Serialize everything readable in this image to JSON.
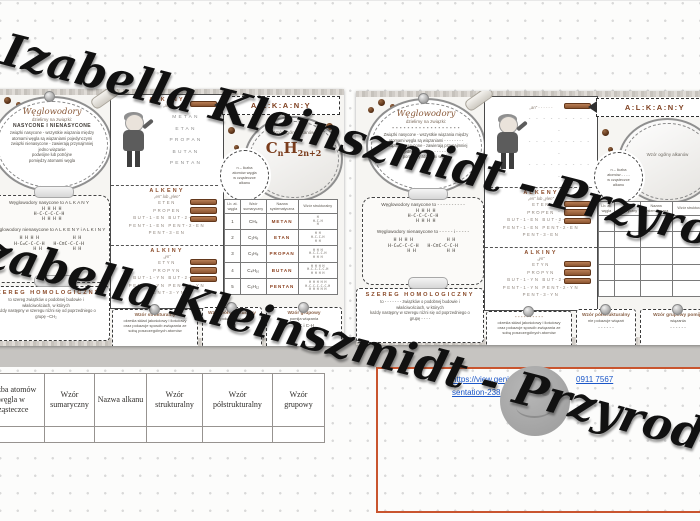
{
  "colors": {
    "accent_brown": "#8a4a28",
    "formula_brown": "#7a3c1c",
    "link_blue": "#1a56c8",
    "box_orange": "#c9552f",
    "band_gray": "#c6c4c1"
  },
  "watermark": {
    "line": "Izabella Kleinszmidt - PrzyrodniczeEcho"
  },
  "page1": {
    "oval": {
      "title": "Węglowodory",
      "subtitle": "dzielimy na związki:",
      "emphasis": "NASYCONE I NIENASYCONE",
      "lines": "związki nasycone - wszystkie wiązania między\natomami węgla są wiązaniami pojedynczymi\nzwiązki nienasycone - zawierają przynajmniej\njedno wiązanie\npodwójne lub potrójne\npomiędzy atomami węgla"
    },
    "sat": {
      "line1": "Węglowodory nasycone to  A L K A N Y",
      "formula1": "  H H H H\nH-C-C-C-C-H\n  H H H H",
      "line2": "Węglowodory nienasycone to  A L K E N Y  i  A L K I N Y",
      "formula2a": "H H H H\nH-C=C-C-C-H\n      H H",
      "formula2b": "      H H\nH-C≡C-C-C-H\n      H H"
    },
    "szereg": {
      "title": "SZEREG HOMOLOGICZNY",
      "text": "to szereg związków o podobnej budowie i\nwłaściwościach, w których\nkażdy następny w szeregu różni się od poprzedniego o\ngrupę –CH₂"
    },
    "alkany": {
      "title": "ALKANY",
      "suffix": "„an”",
      "names": [
        "METAN",
        "ETAN",
        "PROPAN",
        "BUTAN",
        "PENTAN"
      ]
    },
    "alkeny": {
      "title": "ALKENY",
      "suffix": "„en” lub „ylen”",
      "names": [
        "ETEN",
        "PROPEN",
        "BUT-1-EN  BUT-2-EN",
        "PENT-1-EN  PENT-2-EN",
        "PENT-3-EN"
      ]
    },
    "alkiny": {
      "title": "ALKINY",
      "suffix": "„yn”",
      "names": [
        "ETYN",
        "PROPYN",
        "BUT-1-YN  BUT-2-YN",
        "PENT-1-YN  PENT-2-YN",
        "PENT-3-YN"
      ]
    },
    "ribbon": "A:L:K:A:N:Y",
    "general": {
      "label": "Wzór ogólny alkanów",
      "c": "C",
      "n": "n",
      "h": "H",
      "sub": "2n+2"
    },
    "circle_note": "n – liczba\natomów węgla\nw cząsteczce\nalkanu",
    "table": {
      "headers": [
        "Lb. at.\nwęgla",
        "Wzór\nsumaryczny",
        "Nazwa\nsystematyczna",
        "Wzór strukturalny"
      ],
      "rows": [
        {
          "n": "1",
          "sum": "CH₄",
          "name": "METAN",
          "struct": "H\nH-C-H\nH"
        },
        {
          "n": "2",
          "sum": "C₂H₆",
          "name": "ETAN",
          "struct": "H H\nH-C-C-H\nH H"
        },
        {
          "n": "3",
          "sum": "C₃H₈",
          "name": "PROPAN",
          "struct": "H H H\nH-C-C-C-H\nH H H"
        },
        {
          "n": "4",
          "sum": "C₄H₁₀",
          "name": "BUTAN",
          "struct": "H H H H\nH-C-C-C-C-H\nH H H H"
        },
        {
          "n": "5",
          "sum": "C₅H₁₂",
          "name": "PENTAN",
          "struct": "H H H H H\nH-C-C-C-C-C-H\nH H H H H"
        }
      ]
    },
    "banner_struct": {
      "title": "Wzór strukturalny",
      "text": "określa skład jakościowy i ilościowy\noraz pokazuje sposób związania ze\nsobą poszczególnych atomów"
    },
    "banner_semi": {
      "title": "Wzór półstrukturalny",
      "text": "nie pokazuje wiązań",
      "value": "C-H"
    },
    "banner_group": {
      "title": "Wzór grupowy",
      "text": "pomija wiązania",
      "value": "C-C i C-H"
    }
  },
  "page2": {
    "oval": {
      "title": "Węglowodory",
      "subtitle": "dzielimy na związki:",
      "emphasis": "- - - - - - - - - - - - - - - - - -",
      "lines": "Związki nasycone - wszystkie wiązania między\natomami węgla są wiązaniami - - - - - - - -\nZwiązki nienasycone - zawierają przynajmniej\njedno wiązanie - - - - - - -\npomiędzy atomami węgla"
    },
    "sat": {
      "line1": "Węglowodory nasycone to  - - - - - - - - - -",
      "formula1": "  H H H H\nH-C-C-C-C-H\n  H H H H",
      "line2": "Węglowodory nienasycone to  - - - - -  i  - - - - -",
      "formula2a": "H H H H\nH-C=C-C-C-H\n      H H",
      "formula2b": "      H H\nH-C≡C-C-C-H\n      H H"
    },
    "szereg": {
      "title": "SZEREG HOMOLOGICZNY",
      "text": "to - - - - - - - związków o podobnej budowie i\nwłaściwościach, w których\nkażdy następny w szeregu różni się od poprzedniego o\ngrupę - - - -"
    },
    "alkany": {
      "title": "",
      "suffix": "„an”  - - - - - -",
      "names": [
        "- - - - - - - - - -",
        "- - - - - - - - - -",
        "- - - - - - - - - -",
        "- - - - - - - - - -",
        "- - - - - - - - - -"
      ]
    },
    "alkeny": {
      "title": "ALKENY",
      "suffix": "„en” lub „ylen”",
      "names": [
        "ETEN",
        "PROPEN",
        "BUT-1-EN  BUT-2-EN",
        "PENT-1-EN  PENT-2-EN",
        "PENT-3-EN"
      ]
    },
    "alkiny": {
      "title": "ALKINY",
      "suffix": "„yn”",
      "names": [
        "ETYN",
        "PROPYN",
        "BUT-1-YN  BUT-2-YN",
        "PENT-1-YN  PENT-2-YN",
        "PENT-3-YN"
      ]
    },
    "ribbon": "A:L:K:A:N:Y",
    "general": {
      "label": "Wzór ogólny alkanów",
      "c": "",
      "n": "",
      "h": "",
      "sub": ""
    },
    "circle_note": "n – liczba\natomów - - - -\nw cząsteczce\nalkanu",
    "table": {
      "headers": [
        "Lb. at.\nwęgla",
        "Wzór\nsumaryczny",
        "Nazwa\nsystematyczna",
        "Wzór strukturalny"
      ],
      "rows": [
        {
          "n": "",
          "sum": "",
          "name": "",
          "struct": ""
        },
        {
          "n": "",
          "sum": "",
          "name": "",
          "struct": ""
        },
        {
          "n": "",
          "sum": "",
          "name": "",
          "struct": ""
        },
        {
          "n": "",
          "sum": "",
          "name": "",
          "struct": ""
        },
        {
          "n": "",
          "sum": "",
          "name": "",
          "struct": ""
        }
      ]
    },
    "banner_struct": {
      "title": "- - - - - - - - - -",
      "text": "określa skład jakościowy i ilościowy\noraz pokazuje sposób związania ze\nsobą poszczególnych atomów"
    },
    "banner_semi": {
      "title": "Wzór półstrukturalny",
      "text": "nie pokazuje wiązań",
      "value": "- - - - - -"
    },
    "banner_group": {
      "title": "Wzór grupowy pomija",
      "text": "wiązania",
      "value": "- - - - - -"
    }
  },
  "footer": {
    "page_number": "2"
  },
  "doc_table": {
    "headers": [
      "Liczba atomów\nwęgla w\ncząsteczce",
      "Wzór\nsumaryczny",
      "Nazwa alkanu",
      "Wzór strukturalny",
      "Wzór półstrukturalny",
      "Wzór grupowy"
    ]
  },
  "link_box": {
    "url_line1": "https://view.geni",
    "url_line1_tail": "0911  7567",
    "url_line2": "sentation-238"
  }
}
